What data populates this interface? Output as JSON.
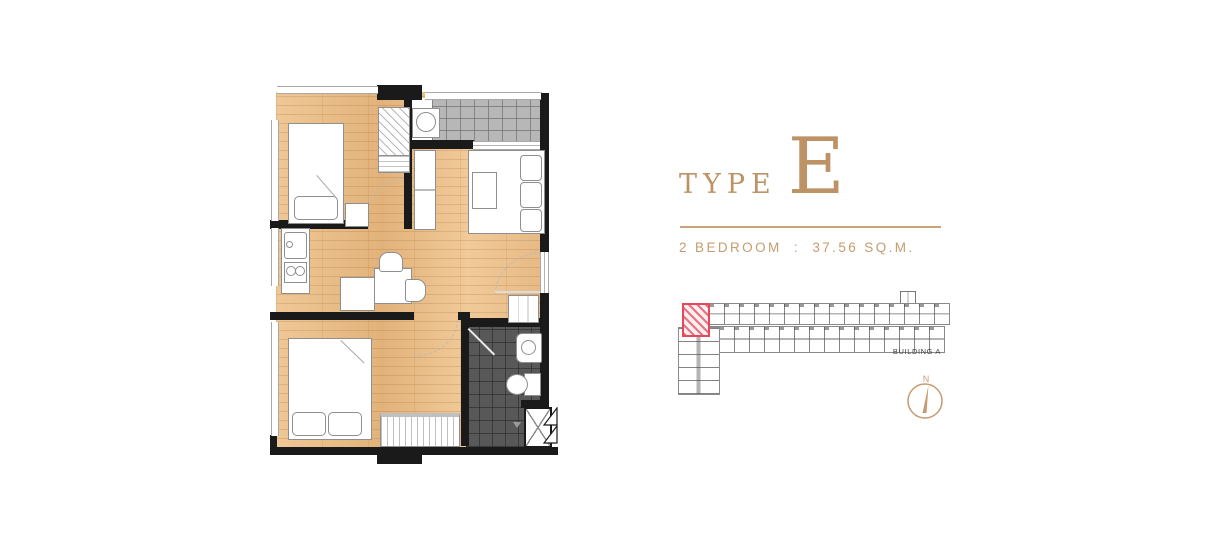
{
  "header": {
    "type_label": "TYPE",
    "type_letter": "E",
    "spec": "2 BEDROOM  :  37.56 SQ.M."
  },
  "key_plan": {
    "building_label": "BUILDING A"
  },
  "compass": {
    "north_label": "N"
  },
  "colors": {
    "gold": "#bd9365",
    "gold_line": "#c9a276",
    "gold_light": "#c49c6f",
    "highlight_red": "#e3485c",
    "wall_black": "#1a1a1a"
  }
}
